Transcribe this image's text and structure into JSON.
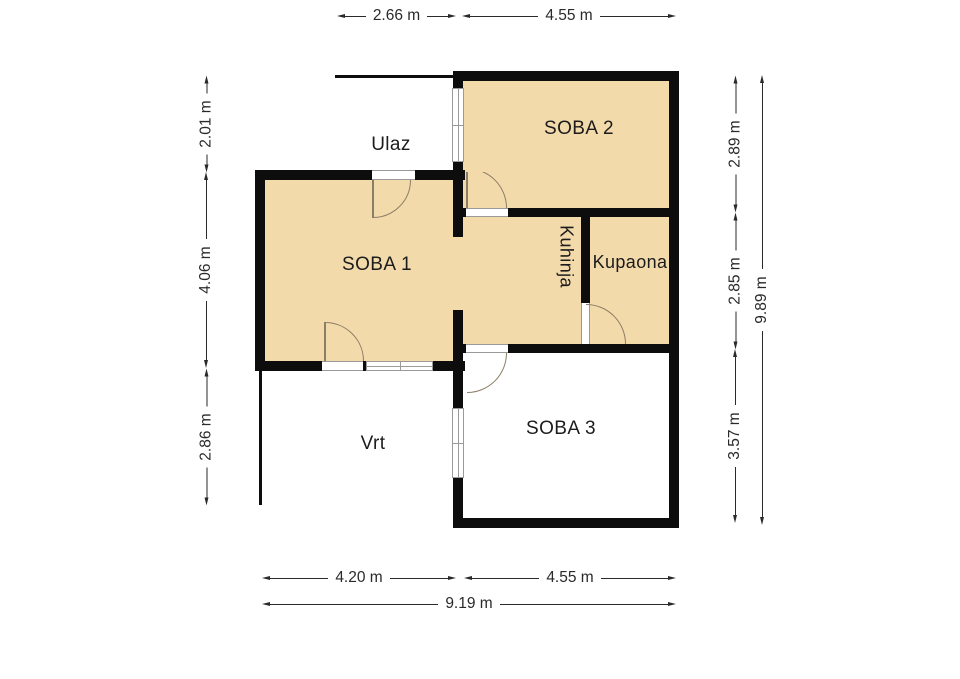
{
  "title": "Floor plan",
  "rooms": [
    {
      "name": "soba-1",
      "label": "SOBA 1"
    },
    {
      "name": "soba-2",
      "label": "SOBA 2"
    },
    {
      "name": "soba-3",
      "label": "SOBA 3"
    },
    {
      "name": "kuhinja",
      "label": "Kuhinja"
    },
    {
      "name": "kupaona",
      "label": "Kupaona"
    }
  ],
  "outdoor_areas": [
    {
      "name": "ulaz",
      "label": "Ulaz"
    },
    {
      "name": "vrt",
      "label": "Vrt"
    }
  ],
  "dimensions": {
    "top": [
      "2.66 m",
      "4.55 m"
    ],
    "bottom": [
      "4.20 m",
      "4.55 m"
    ],
    "bottom_total": "9.19 m",
    "left": [
      "2.01 m",
      "4.06 m",
      "2.86 m"
    ],
    "right": [
      "2.89 m",
      "2.85 m",
      "3.57 m"
    ],
    "right_total": "9.89 m"
  },
  "colors": {
    "wall": "#0d0d0d",
    "floor": "#f3daab",
    "arc": "#8b7e66",
    "dim": "#2a2a2a",
    "sill": "#9a9a9a"
  }
}
